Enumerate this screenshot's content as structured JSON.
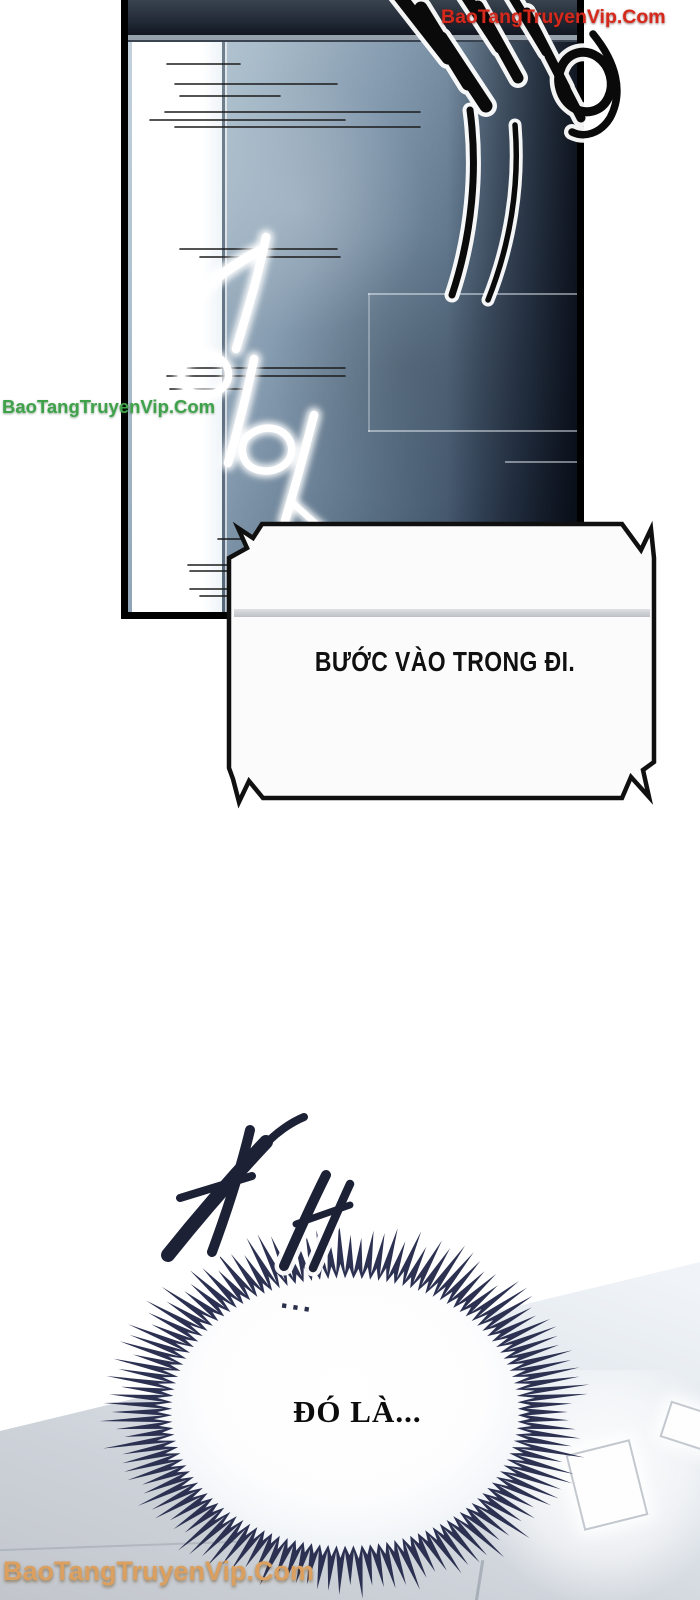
{
  "page": {
    "background": "#ffffff"
  },
  "watermarks": {
    "top_right": {
      "text": "BaoTangTruyenVip.Com",
      "color": "#d6291c"
    },
    "left": {
      "text": "BaoTangTruyenVip.Com",
      "color": "#3fa24b"
    },
    "bottom_left": {
      "text": "BaoTangTruyenVip.Com",
      "color": "#dba05f"
    }
  },
  "dialogue": {
    "command_bubble": {
      "text": "BƯỚC VÀO TRONG ĐI."
    },
    "burst_bubble": {
      "ellipsis": "...",
      "text": "ĐÓ LÀ..."
    }
  },
  "sfx": {
    "impact": "쾅",
    "whoosh": "기이잉",
    "footsteps": "저벅"
  },
  "colors": {
    "panel_border": "#000000",
    "wall_dark": "#17202f",
    "wall_mid": "#849aae",
    "wall_light": "#c6d4df",
    "burst_spikes": "#2c3152",
    "sfx_ink": "#15192c",
    "floor_grey": "#c2c6cc"
  }
}
